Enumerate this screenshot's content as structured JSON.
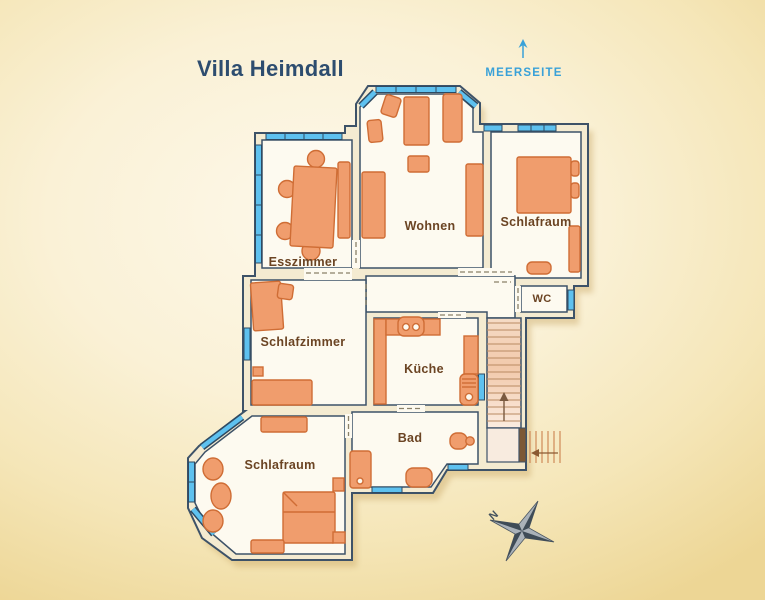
{
  "title": "Villa Heimdall",
  "sea_side": {
    "label": "MEERSEITE"
  },
  "rooms": [
    {
      "label": "Esszimmer"
    },
    {
      "label": "Wohnen"
    },
    {
      "label": "Schlafraum"
    },
    {
      "label": "WC"
    },
    {
      "label": "Schlafzimmer"
    },
    {
      "label": "Küche"
    },
    {
      "label": "Bad"
    },
    {
      "label": "Schlafraum"
    }
  ],
  "compass": {
    "north_label": "N"
  },
  "colors": {
    "title": "#2d4d6f",
    "sea_label": "#39a1d8",
    "room_label": "#6b4423",
    "wall_outline": "#3d5268",
    "wall_fill": "#f4ebd1",
    "floor_fill": "#fdfaf0",
    "furniture_fill": "#f09d6d",
    "furniture_outline": "#cf6d35",
    "window_blue": "#5ec1ef",
    "background_gold": "#edd695"
  }
}
